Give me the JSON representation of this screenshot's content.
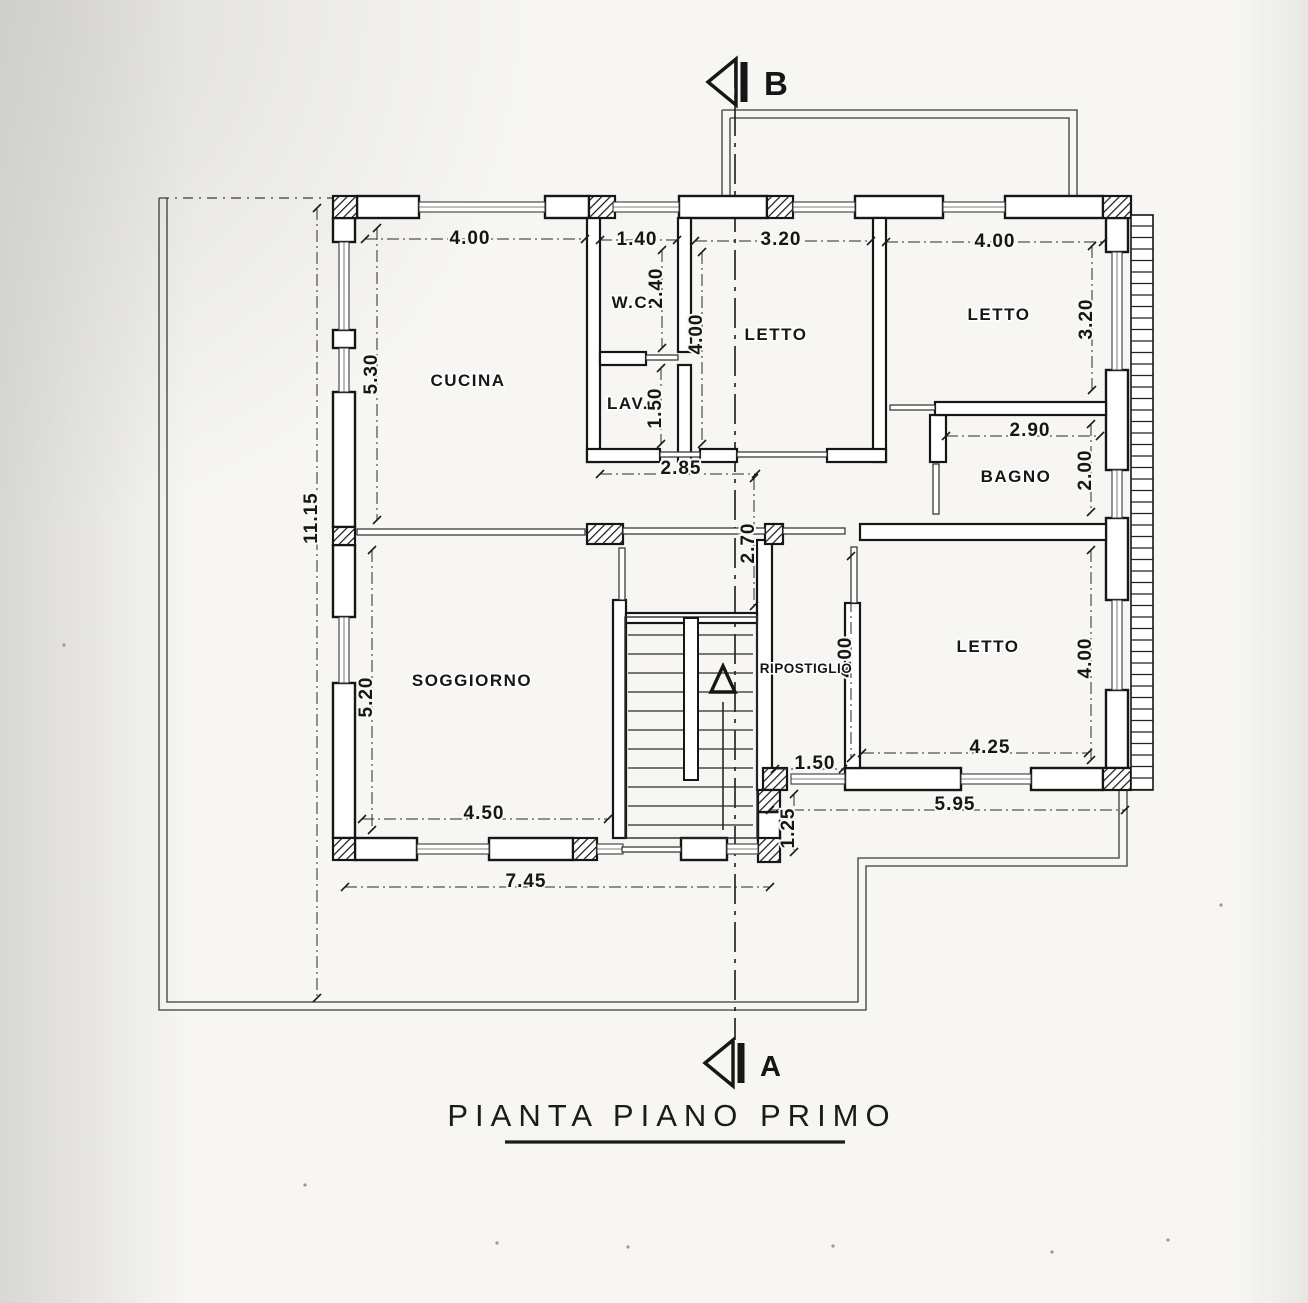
{
  "title": {
    "text": "PIANTA PIANO PRIMO"
  },
  "section_markers": {
    "top": "B",
    "bottom": "A"
  },
  "rooms": [
    {
      "name": "CUCINA",
      "x": 468,
      "y": 386
    },
    {
      "name": "W.C.",
      "x": 633,
      "y": 308
    },
    {
      "name": "LAV.",
      "x": 628,
      "y": 409
    },
    {
      "name": "LETTO",
      "x": 776,
      "y": 340
    },
    {
      "name": "LETTO",
      "x": 999,
      "y": 320
    },
    {
      "name": "BAGNO",
      "x": 1016,
      "y": 482
    },
    {
      "name": "SOGGIORNO",
      "x": 472,
      "y": 686
    },
    {
      "name": "RIPOSTIGLIO",
      "x": 806,
      "y": 673,
      "small": true
    },
    {
      "name": "LETTO",
      "x": 988,
      "y": 652
    }
  ],
  "dimensions": [
    {
      "t": "4.00",
      "x": 470,
      "y": 244
    },
    {
      "t": "1.40",
      "x": 637,
      "y": 245
    },
    {
      "t": "3.20",
      "x": 781,
      "y": 245
    },
    {
      "t": "4.00",
      "x": 995,
      "y": 247
    },
    {
      "t": "2.40",
      "x": 662,
      "y": 288,
      "v": true
    },
    {
      "t": "4.00",
      "x": 702,
      "y": 334,
      "v": true
    },
    {
      "t": "5.30",
      "x": 377,
      "y": 374,
      "v": true
    },
    {
      "t": "1.50",
      "x": 661,
      "y": 408,
      "v": true
    },
    {
      "t": "3.20",
      "x": 1092,
      "y": 319,
      "v": true
    },
    {
      "t": "2.90",
      "x": 1030,
      "y": 436
    },
    {
      "t": "2.00",
      "x": 1091,
      "y": 470,
      "v": true
    },
    {
      "t": "2.85",
      "x": 681,
      "y": 474
    },
    {
      "t": "2.70",
      "x": 754,
      "y": 543,
      "v": true
    },
    {
      "t": "11.15",
      "x": 317,
      "y": 518,
      "v": true
    },
    {
      "t": "4.00",
      "x": 851,
      "y": 657,
      "v": true
    },
    {
      "t": "4.00",
      "x": 1091,
      "y": 658,
      "v": true
    },
    {
      "t": "5.20",
      "x": 372,
      "y": 697,
      "v": true
    },
    {
      "t": "4.25",
      "x": 990,
      "y": 753
    },
    {
      "t": "1.50",
      "x": 815,
      "y": 769
    },
    {
      "t": "4.50",
      "x": 484,
      "y": 819
    },
    {
      "t": "5.95",
      "x": 955,
      "y": 810
    },
    {
      "t": "1.25",
      "x": 794,
      "y": 828,
      "v": true
    },
    {
      "t": "7.45",
      "x": 526,
      "y": 887
    }
  ],
  "colors": {
    "ink": "#1b1b1b",
    "paper": "#f7f6f3"
  }
}
